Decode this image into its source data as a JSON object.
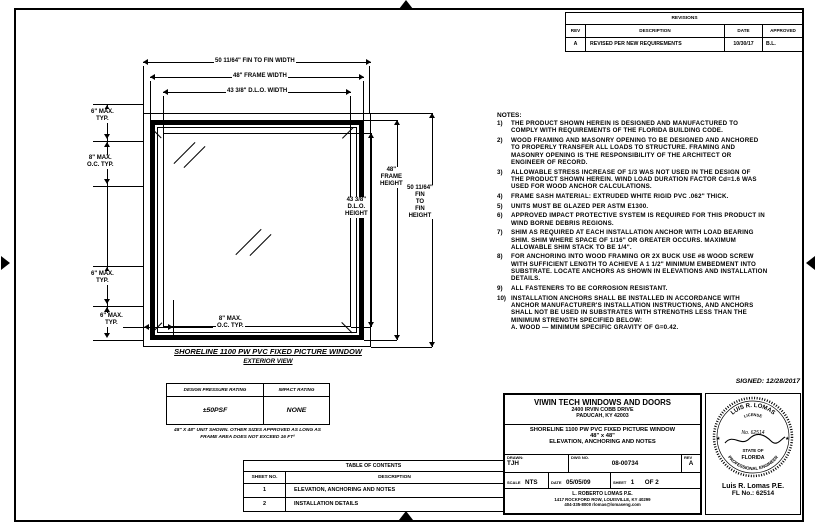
{
  "revisions": {
    "title": "REVISIONS",
    "headers": {
      "rev": "REV",
      "description": "DESCRIPTION",
      "date": "DATE",
      "approved": "APPROVED"
    },
    "rows": [
      {
        "rev": "A",
        "description": "REVISED PER NEW REQUIREMENTS",
        "date": "10/30/17",
        "approved": "B.L."
      }
    ]
  },
  "elevation": {
    "dims": {
      "fin_width": "50 11/64\" FIN TO FIN WIDTH",
      "frame_width": "48\" FRAME WIDTH",
      "dlo_width": "43 3/8\" D.L.O. WIDTH",
      "dlo_height": "43 3/8\"\nD.L.O.\nHEIGHT",
      "frame_height": "48\"\nFRAME\nHEIGHT",
      "fin_height": "50 11/64\"\nFIN\nTO\nFIN\nHEIGHT",
      "edge_top": "6\" MAX.\nTYP.",
      "spacing_side": "8\" MAX.\nO.C. TYP.",
      "edge_bottom": "6\" MAX.\nTYP.",
      "edge_corner": "6\" MAX.\nTYP.",
      "spacing_bottom": "8\" MAX.\nO.C. TYP."
    },
    "title": "SHORELINE 1100 PW PVC FIXED PICTURE WINDOW",
    "subtitle": "EXTERIOR VIEW"
  },
  "rating_table": {
    "col_pressure": "DESIGN PRESSURE RATING",
    "col_impact": "IMPACT RATING",
    "pressure": "±50PSF",
    "impact": "NONE",
    "footnote": "48\" X 48\" UNIT SHOWN. OTHER SIZES APPROVED AS LONG AS\nFRAME AREA DOES NOT EXCEED 16 FT²"
  },
  "notes": {
    "title": "NOTES:",
    "items": [
      {
        "num": "1)",
        "text": "THE PRODUCT SHOWN HEREIN IS DESIGNED AND MANUFACTURED TO\nCOMPLY WITH REQUIREMENTS OF THE FLORIDA BUILDING CODE."
      },
      {
        "num": "2)",
        "text": "WOOD FRAMING AND MASONRY OPENING TO BE DESIGNED AND ANCHORED\nTO PROPERLY TRANSFER ALL LOADS TO STRUCTURE. FRAMING AND\nMASONRY OPENING IS THE RESPONSIBILITY OF THE ARCHITECT OR\nENGINEER OF RECORD."
      },
      {
        "num": "3)",
        "text": "ALLOWABLE STRESS INCREASE OF 1/3 WAS NOT USED IN THE DESIGN OF\nTHE PRODUCT SHOWN HEREIN. WIND LOAD DURATION FACTOR Cd=1.6 WAS\nUSED FOR WOOD ANCHOR CALCULATIONS."
      },
      {
        "num": "4)",
        "text": "FRAME SASH MATERIAL: EXTRUDED WHITE RIGID PVC .062\" THICK."
      },
      {
        "num": "5)",
        "text": "UNITS MUST BE GLAZED PER ASTM E1300."
      },
      {
        "num": "6)",
        "text": "APPROVED IMPACT PROTECTIVE SYSTEM IS REQUIRED FOR THIS PRODUCT IN\nWIND BORNE DEBRIS REGIONS."
      },
      {
        "num": "7)",
        "text": "SHIM AS REQUIRED AT EACH INSTALLATION ANCHOR WITH LOAD BEARING\nSHIM. SHIM WHERE SPACE OF 1/16\" OR GREATER OCCURS. MAXIMUM\nALLOWABLE SHIM STACK TO BE 1/4\"."
      },
      {
        "num": "8)",
        "text": "FOR ANCHORING INTO WOOD FRAMING OR 2X BUCK USE #8 WOOD SCREW\nWITH SUFFICIENT LENGTH TO ACHIEVE A 1 1/2\" MINIMUM EMBEDMENT INTO\nSUBSTRATE. LOCATE ANCHORS AS SHOWN IN ELEVATIONS AND INSTALLATION\nDETAILS."
      },
      {
        "num": "9)",
        "text": "ALL FASTENERS TO BE CORROSION RESISTANT."
      },
      {
        "num": "10)",
        "text": "INSTALLATION ANCHORS SHALL BE INSTALLED IN ACCORDANCE WITH\nANCHOR MANUFACTURER'S INSTALLATION INSTRUCTIONS, AND ANCHORS\nSHALL NOT BE USED IN SUBSTRATES WITH STRENGTHS LESS THAN THE\nMINIMUM STRENGTH SPECIFIED BELOW:\nA. WOOD — MINIMUM SPECIFIC GRAVITY OF G=0.42."
      }
    ]
  },
  "signed": "SIGNED: 12/28/2017",
  "title_block": {
    "company": "VIWIN TECH WINDOWS AND DOORS",
    "address1": "2400 IRVIN COBB DRIVE",
    "address2": "PADUCAH, KY 42003",
    "product": "SHORELINE 1100 PW PVC FIXED PICTURE WINDOW",
    "size": "48\" x 48\"",
    "sheet_title": "ELEVATION, ANCHORING AND NOTES",
    "drawn_label": "DRAWN:",
    "drawn": "TJH",
    "dwg_label": "DWG NO.",
    "dwg_no": "08-00734",
    "rev_label": "REV",
    "rev": "A",
    "scale_label": "SCALE",
    "scale": "NTS",
    "date_label": "DATE",
    "date": "05/05/09",
    "sheet_label": "SHEET",
    "sheet": "1",
    "of": "OF 2",
    "firm1": "L. ROBERTO LOMAS P.E.",
    "firm2": "1417 ROCKFORD ROW, LOUISVILLE, KY 40299",
    "firm3": "404-335-8000   rlomas@lomaseng.com"
  },
  "seal": {
    "arc_top": "LUIS R. LOMAS",
    "license": "LICENSE",
    "number": "No. 62514",
    "state": "STATE OF",
    "florida": "FLORIDA",
    "arc_bottom": "PROFESSIONAL ENGINEER",
    "star": "★",
    "name": "Luis R. Lomas P.E.",
    "fl_no": "FL No.: 62514"
  },
  "toc": {
    "title": "TABLE OF CONTENTS",
    "col_sheet": "SHEET NO.",
    "col_desc": "DESCRIPTION",
    "rows": [
      {
        "sheet": "1",
        "desc": "ELEVATION, ANCHORING AND NOTES"
      },
      {
        "sheet": "2",
        "desc": "INSTALLATION DETAILS"
      }
    ]
  }
}
